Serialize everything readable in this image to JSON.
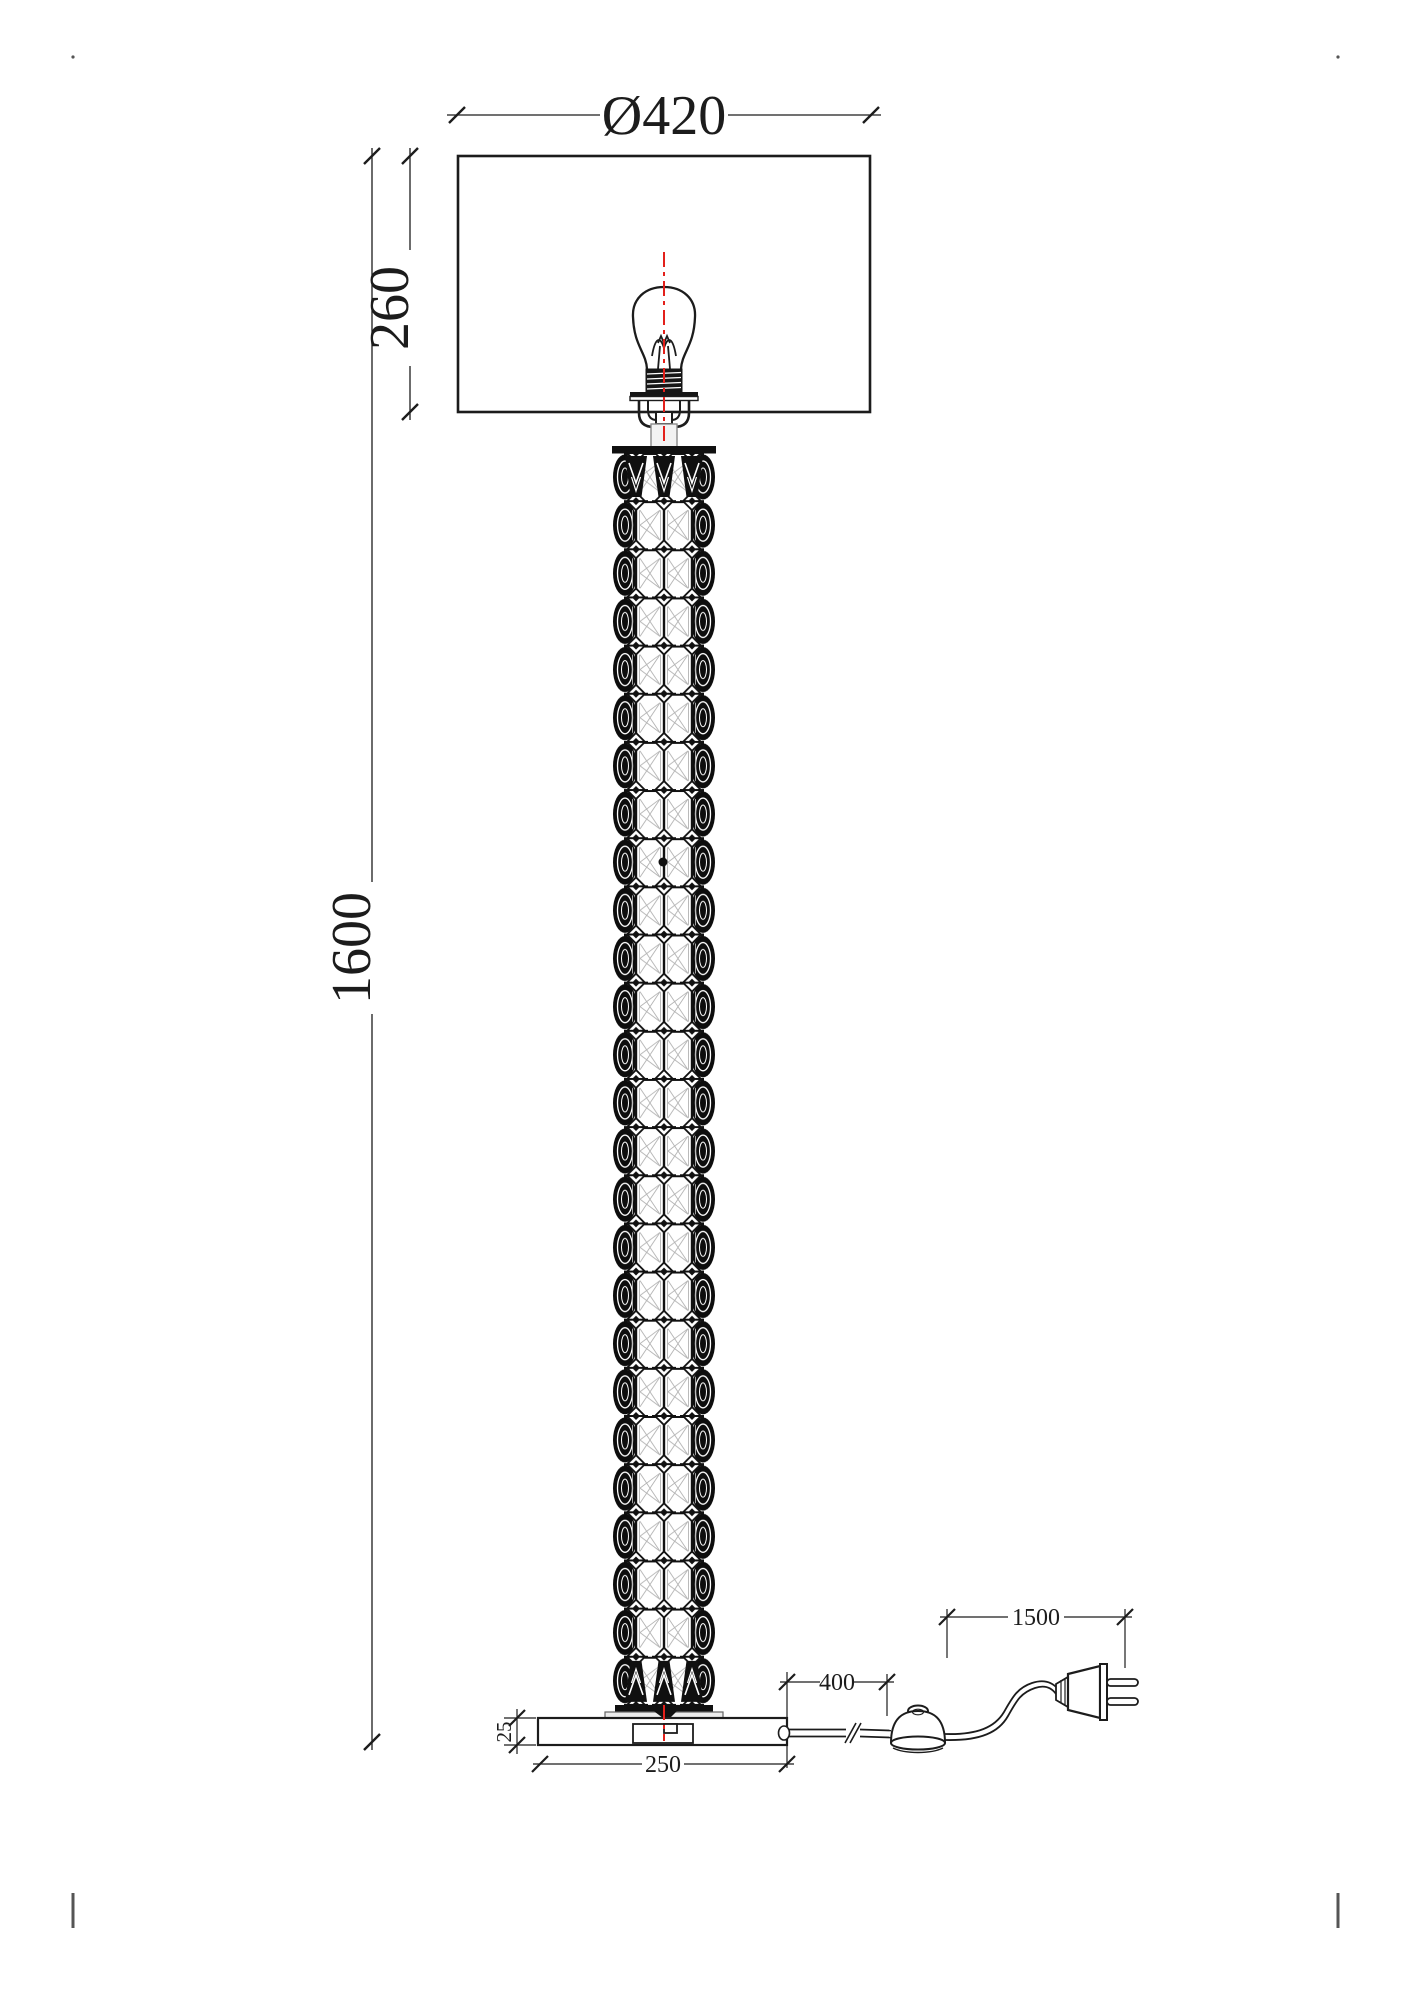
{
  "drawing": {
    "type": "floor lamp technical dimension drawing",
    "labels": {
      "shade_diameter": "Ø420",
      "shade_height": "260",
      "lamp_height": "1600",
      "base_to_switch": "400",
      "cord_length": "1500",
      "base_width": "250",
      "base_thickness": "25"
    },
    "colors": {
      "ink": "#1c1c1c",
      "centerline_red": "#e3201b",
      "background": "#ffffff"
    }
  }
}
